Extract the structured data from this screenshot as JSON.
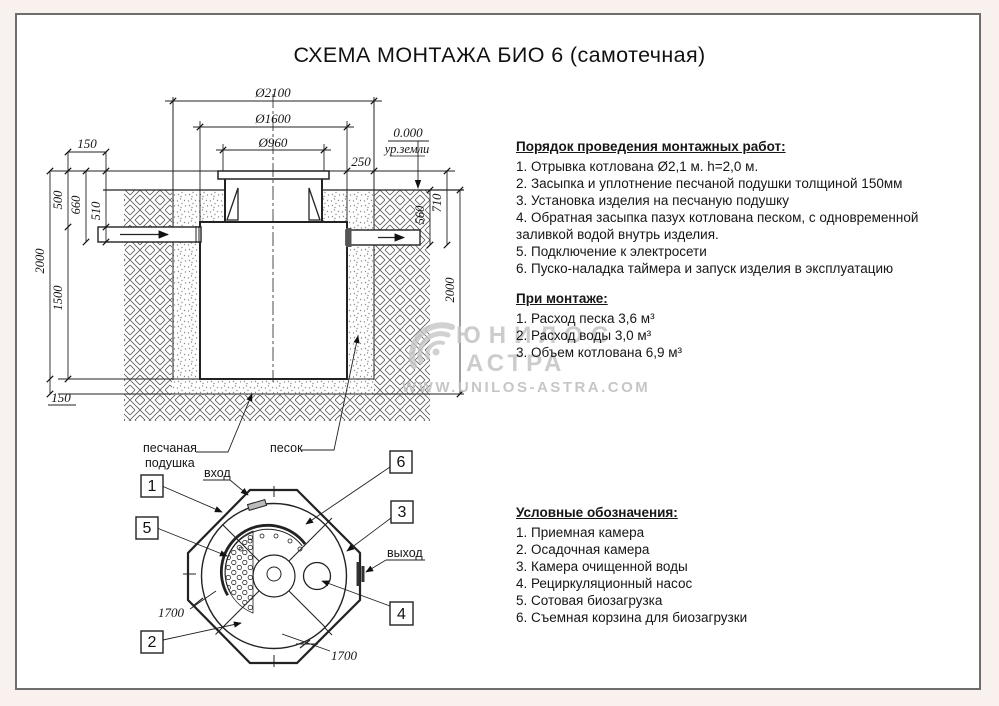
{
  "title": "СХЕМА МОНТАЖА БИО 6 (самотечная)",
  "cross_section": {
    "dia_outer": "Ø2100",
    "dia_mid": "Ø1600",
    "dia_neck": "Ø960",
    "level_zero": "0.000",
    "ground_label": "ур.земли",
    "gap_250": "250",
    "offset_150_top": "150",
    "depth_500": "500",
    "depth_660": "660",
    "depth_510": "510",
    "depth_2000_left": "2000",
    "depth_1500": "1500",
    "cushion_150": "150",
    "depth_560": "560",
    "depth_710": "710",
    "depth_2000_right": "2000",
    "label_sand_cushion_line1": "песчаная",
    "label_sand_cushion_line2": "подушка",
    "label_sand": "песок"
  },
  "plan": {
    "inlet_label": "вход",
    "outlet_label": "выход",
    "dim_1700_left": "1700",
    "dim_1700_bottom": "1700",
    "callout_1": "1",
    "callout_2": "2",
    "callout_3": "3",
    "callout_4": "4",
    "callout_5": "5",
    "callout_6": "6"
  },
  "work_order": {
    "title": "Порядок проведения монтажных работ:",
    "items": [
      "1. Отрывка котлована Ø2,1 м. h=2,0 м.",
      "2. Засыпка и уплотнение песчаной подушки толщиной 150мм",
      "3. Установка изделия на песчаную подушку",
      "4. Обратная засыпка пазух котлована песком, с одновременной заливкой водой внутрь изделия.",
      "5. Подключение к электросети",
      "6. Пуско-наладка таймера и запуск изделия в эксплуатацию"
    ]
  },
  "install_notes": {
    "title": "При монтаже:",
    "items": [
      "1. Расход песка 3,6 м³",
      "2. Расход воды 3,0 м³",
      "3. Объем котлована 6,9 м³"
    ]
  },
  "legend": {
    "title": "Условные обозначения:",
    "items": [
      "1. Приемная камера",
      "2. Осадочная камера",
      "3. Камера очищенной воды",
      "4. Рециркуляционный насос",
      "5. Сотовая биозагрузка",
      "6. Съемная корзина для биозагрузки"
    ]
  },
  "watermark": {
    "brand_line1": "ЮНИЛОС",
    "brand_line2": "АСТРА",
    "url": "WWW.UNILOS-ASTRA.COM"
  },
  "colors": {
    "line": "#222222",
    "sheet_border": "#6e6e6e",
    "watermark": "#c4c4c4",
    "margin_bg": "#f8f1ee"
  }
}
